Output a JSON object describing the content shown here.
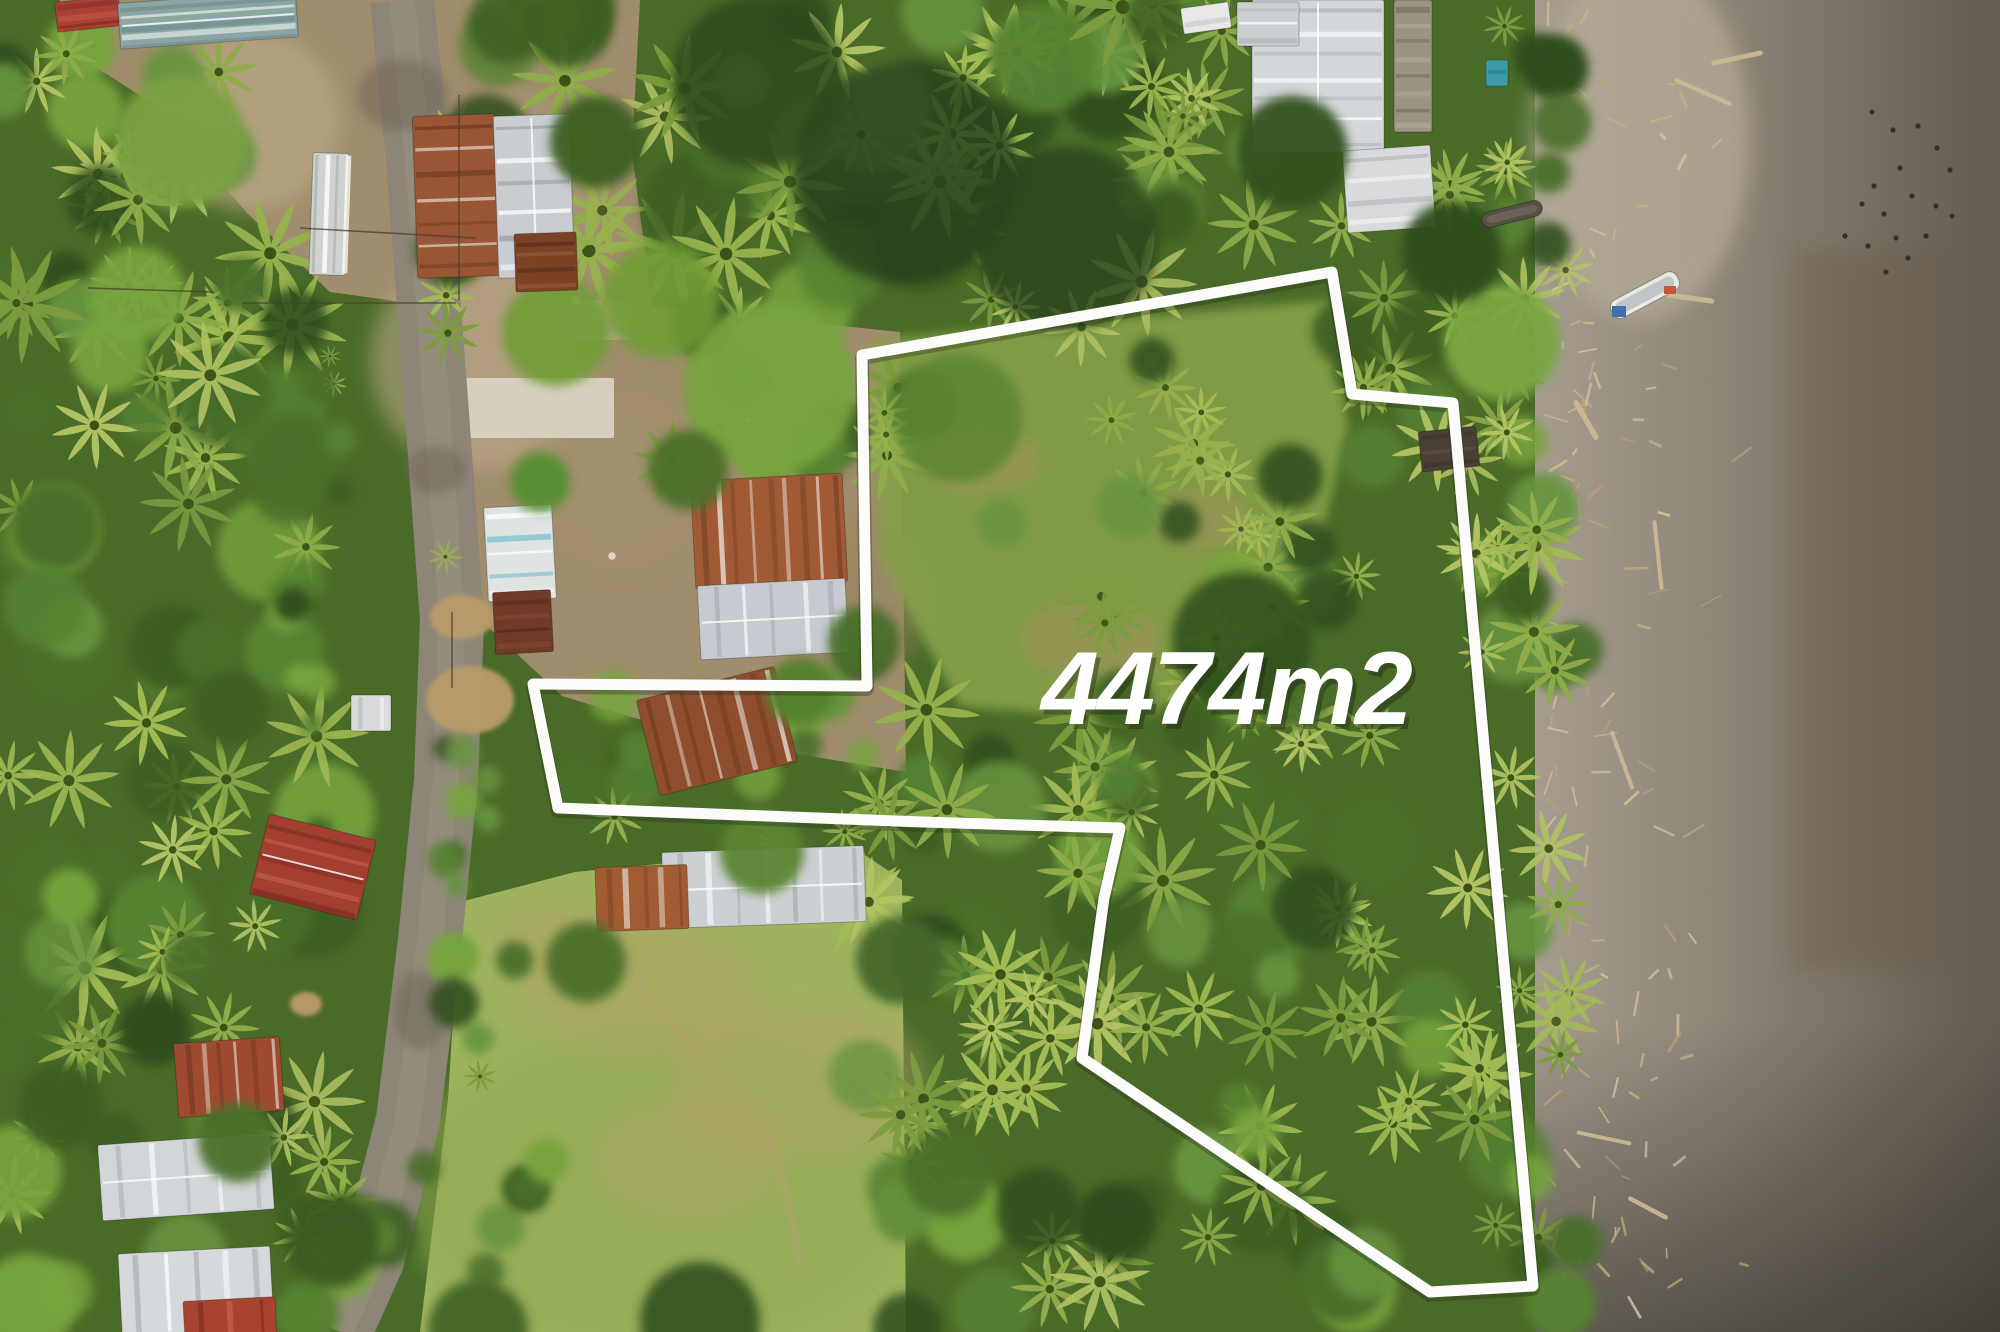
{
  "label": {
    "text": "4474m2",
    "x": 1226,
    "y": 724,
    "color": "#ffffff",
    "shadow": "rgba(25,35,15,0.40)"
  },
  "canvas": {
    "width": 2000,
    "height": 1332
  },
  "palettes": {
    "base": "#4a6b28",
    "canopy": [
      "#2f4d1d",
      "#3c5f24",
      "#49702b",
      "#578231",
      "#679441",
      "#76a43c"
    ],
    "palm": [
      "#8fac4a",
      "#a3bc55",
      "#7d9c3f",
      "#b2c364",
      "#97b14e"
    ],
    "palm_core": "#3c5318"
  },
  "boundary": {
    "stroke": "#ffffff",
    "stroke_width": 11,
    "points": [
      [
        862,
        355
      ],
      [
        1332,
        272
      ],
      [
        1352,
        394
      ],
      [
        1453,
        403
      ],
      [
        1533,
        1286
      ],
      [
        1430,
        1292
      ],
      [
        1082,
        1058
      ],
      [
        1104,
        898
      ],
      [
        1120,
        828
      ],
      [
        923,
        822
      ],
      [
        558,
        808
      ],
      [
        533,
        684
      ],
      [
        867,
        686
      ]
    ]
  },
  "beach": {
    "x": 1535,
    "gradient": [
      "#a59c8e",
      "#8d8578",
      "#746c60",
      "#625c53"
    ],
    "light_blob": [
      1640,
      140,
      110,
      180,
      "#b6ab97"
    ],
    "wet_band": [
      1795,
      250,
      150,
      720,
      "#6a5d4e"
    ],
    "debris": {
      "x0": 1548,
      "x1": 1770,
      "y0": 8,
      "y1": 1326,
      "count": 135,
      "len_min": 7,
      "len_max": 26,
      "colors": [
        "#c9b387",
        "#bba276",
        "#d4c19a"
      ]
    },
    "logs": [
      [
        1703,
        92,
        58,
        24
      ],
      [
        1737,
        58,
        48,
        -12
      ],
      [
        1690,
        298,
        44,
        8
      ],
      [
        1658,
        555,
        66,
        84
      ],
      [
        1622,
        760,
        58,
        70
      ],
      [
        1604,
        1138,
        52,
        12
      ],
      [
        1648,
        1208,
        40,
        28
      ],
      [
        1586,
        420,
        40,
        60
      ]
    ],
    "log_color": "#cdbb92",
    "bird_color": "#2c2a26",
    "birds": [
      [
        1872,
        112
      ],
      [
        1893,
        130
      ],
      [
        1918,
        126
      ],
      [
        1937,
        148
      ],
      [
        1950,
        170
      ],
      [
        1900,
        168
      ],
      [
        1874,
        186
      ],
      [
        1912,
        196
      ],
      [
        1936,
        206
      ],
      [
        1952,
        216
      ],
      [
        1884,
        214
      ],
      [
        1862,
        204
      ],
      [
        1926,
        236
      ],
      [
        1896,
        238
      ],
      [
        1868,
        246
      ],
      [
        1845,
        236
      ],
      [
        1908,
        258
      ],
      [
        1886,
        272
      ]
    ]
  },
  "dirt": {
    "path": "M60,0 H640 L632,152 L652,306 L900,332 L906,772 L702,738 L562,696 L470,610 L450,415 L432,306 L330,292 L248,214 L150,102 L60,44 Z",
    "fill": "#a08d6d",
    "blobs": [
      [
        250,
        120,
        90,
        "#b9a784",
        0.7
      ],
      [
        520,
        180,
        85,
        "#ac9876",
        0.6
      ],
      [
        480,
        360,
        110,
        "#c0ab8c",
        0.55
      ],
      [
        850,
        600,
        80,
        "#96835f",
        0.5
      ],
      [
        620,
        480,
        90,
        "#a5916f",
        0.5
      ]
    ],
    "concrete": [
      462,
      378,
      152,
      60,
      "#d9d2c2"
    ],
    "concrete2": [
      560,
      300,
      70,
      40,
      "#c7bba6"
    ],
    "junk_dots": [
      [
        576,
        300
      ],
      [
        702,
        362
      ],
      [
        832,
        592
      ],
      [
        612,
        556
      ],
      [
        748,
        420
      ]
    ],
    "junk_color": "#e9e3d5"
  },
  "field": {
    "path": "M460,902 L575,872 L720,858 L862,853 L902,880 L906,1332 L420,1332 L448,1100 Z",
    "fill": "#9fb35e",
    "shade": [
      660,
      1190,
      260,
      170,
      "#8fa751"
    ],
    "dry_patches": [
      [
        640,
        990,
        120,
        70
      ],
      [
        800,
        1080,
        130,
        80
      ],
      [
        690,
        1160,
        95,
        60
      ],
      [
        560,
        940,
        70,
        40
      ]
    ],
    "dry_color": "#b4a06a",
    "trail": "M612,955 Q700,1060 762,1120 Q790,1190 800,1270",
    "trail_color": "#b3a071"
  },
  "road": {
    "center": [
      [
        402,
        0
      ],
      [
        418,
        160
      ],
      [
        436,
        400
      ],
      [
        452,
        620
      ],
      [
        446,
        780
      ],
      [
        430,
        940
      ],
      [
        408,
        1120
      ],
      [
        372,
        1260
      ],
      [
        340,
        1332
      ]
    ],
    "width": 64,
    "fill": "#8d8577",
    "hi": "#9c9384",
    "dark_patches": [
      [
        402,
        95,
        46,
        36
      ],
      [
        436,
        470,
        30,
        24
      ],
      [
        420,
        1010,
        26,
        40
      ]
    ],
    "patch_color": "#6e6557",
    "puddles": [
      [
        462,
        617,
        32,
        22
      ],
      [
        470,
        700,
        44,
        34
      ],
      [
        306,
        1004,
        16,
        12
      ]
    ],
    "puddle_color": "#ba9b6a"
  },
  "parcel_grass": {
    "path": "M872,340 L1330,300 L1348,430 L1300,620 L1140,722 L960,706 L880,560 Z",
    "fill": "#86a049",
    "patches": [
      [
        1090,
        640,
        70,
        40
      ],
      [
        980,
        460,
        60,
        35
      ],
      [
        1200,
        520,
        50,
        30
      ]
    ],
    "patch_color": "#a89263"
  },
  "tree_zones": [
    [
      "topleft-trees",
      0,
      40,
      240,
      262,
      18,
      0.4,
      24,
      48
    ],
    [
      "topcenter-forest",
      420,
      0,
      1200,
      335,
      64,
      0.45,
      26,
      56
    ],
    [
      "above-barn",
      650,
      320,
      900,
      478,
      13,
      0.4,
      20,
      40
    ],
    [
      "topright-trees",
      1150,
      0,
      1272,
      235,
      12,
      0.5,
      22,
      44
    ],
    [
      "beachline-top",
      1495,
      0,
      1568,
      430,
      12,
      0.45,
      18,
      36
    ],
    [
      "right-of-parcel-top",
      1330,
      180,
      1530,
      480,
      22,
      0.5,
      20,
      42
    ],
    [
      "left-band-forest",
      0,
      250,
      332,
      1332,
      95,
      0.5,
      22,
      52
    ],
    [
      "notch-bushes",
      556,
      636,
      900,
      844,
      20,
      0.35,
      14,
      34
    ],
    [
      "field-edge",
      420,
      860,
      560,
      1332,
      12,
      0.1,
      12,
      26
    ],
    [
      "roadside-west",
      286,
      318,
      342,
      900,
      14,
      0.1,
      10,
      22
    ],
    [
      "roadside-east",
      440,
      556,
      498,
      905,
      9,
      0.1,
      10,
      20
    ],
    [
      "field-right-forest",
      898,
      828,
      1085,
      1332,
      20,
      0.5,
      22,
      44
    ],
    [
      "parcel-mid-dense",
      1080,
      560,
      1310,
      790,
      18,
      0.5,
      22,
      42
    ],
    [
      "parcel-bottom-forest",
      858,
      700,
      1432,
      1302,
      72,
      0.55,
      22,
      48
    ],
    [
      "parcel-top-sparse",
      880,
      305,
      1320,
      560,
      13,
      0.6,
      18,
      38
    ],
    [
      "parcel-right-band",
      1180,
      380,
      1365,
      700,
      15,
      0.6,
      20,
      40
    ],
    [
      "right-of-parcel-mid",
      1455,
      430,
      1578,
      1332,
      36,
      0.6,
      20,
      44
    ],
    [
      "bottom-left-extra",
      300,
      1200,
      430,
      1332,
      8,
      0.3,
      18,
      36
    ]
  ],
  "accent_canopies": [
    [
      770,
      388,
      86,
      "#76a43c",
      0.95
    ],
    [
      662,
      300,
      58,
      "#6f9c35",
      0.9
    ],
    [
      180,
      142,
      66,
      "#79a143",
      0.95
    ],
    [
      905,
      172,
      112,
      "#26401a",
      0.8
    ],
    [
      1066,
      238,
      92,
      "#2b451c",
      0.8
    ],
    [
      758,
      82,
      86,
      "#2e4a1e",
      0.85
    ],
    [
      556,
      332,
      54,
      "#6f9c35",
      0.9
    ],
    [
      1242,
      642,
      70,
      "#33511f",
      0.9
    ],
    [
      1502,
      342,
      58,
      "#7aa742",
      0.95
    ],
    [
      958,
      418,
      64,
      "#5a8533",
      0.85
    ]
  ],
  "buildings": [
    [
      "roof-topleft-red",
      88,
      14,
      64,
      30,
      -6,
      "#a84034",
      3,
      "h",
      "#c05a48",
      "#7e2c22",
      false
    ],
    [
      "roof-topleft-teal",
      208,
      20,
      178,
      46,
      -4,
      "#8aa5a3",
      5,
      "h",
      "#ffffff",
      "#6d8a8a",
      true
    ],
    [
      "shed-roadside-white",
      329,
      214,
      36,
      122,
      2,
      "#cfd2cf",
      4,
      "v",
      "#ffffff",
      "#aab0ae",
      false
    ],
    [
      "house-top-rust",
      456,
      196,
      82,
      162,
      -2,
      "#9a5634",
      7,
      "h",
      "#ddd8cc",
      "#6e3b22",
      false
    ],
    [
      "house-top-silver",
      534,
      196,
      76,
      162,
      -2,
      "#c9ccd1",
      6,
      "h",
      "#ffffff",
      "#9aa0a6",
      true
    ],
    [
      "shed-rust-dark",
      546,
      262,
      62,
      58,
      -2,
      "#7c4226",
      4,
      "h",
      "#9a5a36",
      "#5e2f1a",
      false
    ],
    [
      "house-teal-white",
      520,
      553,
      68,
      94,
      -3,
      "#dfe3e2",
      5,
      "h",
      "#5fb7c4",
      "#ffffff",
      false
    ],
    [
      "roof-brown-dark",
      523,
      622,
      58,
      62,
      -3,
      "#6f3a28",
      4,
      "h",
      "#8a4a32",
      "#54291c",
      false
    ],
    [
      "barn-rust",
      769,
      531,
      152,
      108,
      -3,
      "#a05a36",
      9,
      "v",
      "#e8e4da",
      "#7c4426",
      false
    ],
    [
      "barn-silver",
      773,
      619,
      148,
      74,
      -3,
      "#c7cad0",
      5,
      "v",
      "#ffffff",
      "#a8adb4",
      true
    ],
    [
      "house-notch-rust",
      717,
      731,
      142,
      98,
      -14,
      "#8e4e2e",
      8,
      "v",
      "#e3ded2",
      "#6e3a20",
      false
    ],
    [
      "house-bottom-silver",
      764,
      887,
      202,
      76,
      -2,
      "#ccd0d4",
      7,
      "v",
      "#ffffff",
      "#a9aeb5",
      true
    ],
    [
      "house-bottom-rust",
      642,
      898,
      92,
      64,
      -2,
      "#a25c33",
      5,
      "v",
      "#d8cfc0",
      "#7c4426",
      false
    ],
    [
      "house-bl-red",
      229,
      1077,
      106,
      74,
      -4,
      "#9e4a30",
      6,
      "v",
      "#d8cabb",
      "#763722",
      false
    ],
    [
      "house-bl-white",
      186,
      1177,
      172,
      76,
      -4,
      "#d3d6d9",
      5,
      "v",
      "#ffffff",
      "#adb2b6",
      true
    ],
    [
      "house-bl2-white",
      196,
      1291,
      152,
      82,
      -3,
      "#d6d9db",
      5,
      "v",
      "#ffffff",
      "#afb4b8",
      false
    ],
    [
      "house-bl2-red",
      230,
      1320,
      92,
      42,
      -3,
      "#a8432f",
      3,
      "v",
      "#c9604a",
      "#7e2c20",
      false
    ],
    [
      "house-red-midleft",
      313,
      867,
      110,
      82,
      14,
      "#a33f2f",
      5,
      "h",
      "#c86a50",
      "#7e2e20",
      true
    ],
    [
      "shack-white-road",
      371,
      713,
      40,
      36,
      0,
      "#d9dbd8",
      2,
      "v",
      "#ffffff",
      "#b8bcb9",
      false
    ],
    [
      "bldg-tr-main",
      1318,
      76,
      132,
      152,
      0,
      "#d4d7da",
      7,
      "h",
      "#ffffff",
      "#b0b5ba",
      true
    ],
    [
      "bldg-tr-wing",
      1268,
      24,
      62,
      44,
      0,
      "#cdd0d3",
      3,
      "h",
      "#ffffff",
      "#b0b5ba",
      false
    ],
    [
      "bldg-tr-lower",
      1389,
      189,
      88,
      82,
      -4,
      "#d8dadc",
      4,
      "h",
      "#ffffff",
      "#b4b8bc",
      false
    ],
    [
      "palapa-thatch",
      1413,
      66,
      38,
      132,
      0,
      "#9b9484",
      8,
      "h",
      "#b5ad9c",
      "#7a7263",
      false
    ],
    [
      "truck-white",
      1206,
      18,
      48,
      26,
      -8,
      "#e8e8e6",
      1,
      "h",
      "#ffffff",
      "#c9c9c5",
      false
    ],
    [
      "tarp-teal",
      1497,
      73,
      22,
      26,
      0,
      "#3e9aa8",
      1,
      "h",
      "#5fb7c4",
      "#2e7c88",
      false
    ],
    [
      "hut-dark-right",
      1449,
      449,
      58,
      40,
      -6,
      "#4a4036",
      3,
      "h",
      "#5c5144",
      "#3a322a",
      false
    ]
  ],
  "overhangs": [
    [
      688,
      470,
      40,
      "#4c712c"
    ],
    [
      800,
      692,
      34,
      "#55802f"
    ],
    [
      596,
      142,
      46,
      "#3c5f24"
    ],
    [
      864,
      642,
      36,
      "#49702b"
    ],
    [
      540,
      482,
      30,
      "#579033"
    ],
    [
      762,
      852,
      42,
      "#5a8533"
    ],
    [
      238,
      1142,
      40,
      "#4c712c"
    ],
    [
      332,
      1242,
      46,
      "#3b5c24"
    ],
    [
      1292,
      152,
      56,
      "#33511f"
    ],
    [
      1452,
      252,
      50,
      "#2f4d1d"
    ],
    [
      700,
      1322,
      60,
      "#375722"
    ],
    [
      478,
      1330,
      50,
      "#426526"
    ],
    [
      586,
      962,
      40,
      "#4c712c"
    ],
    [
      900,
      960,
      44,
      "#44672a"
    ]
  ],
  "boats": [
    [
      "boat-white",
      1645,
      295,
      74,
      20,
      -28,
      "#e9e9e4",
      "#b8bec2"
    ],
    [
      "boat-dark",
      1512,
      214,
      62,
      16,
      -14,
      "#555045",
      "#6d675a"
    ]
  ],
  "boat_items": [
    [
      1612,
      306,
      14,
      11,
      "#3e6fae"
    ],
    [
      1664,
      286,
      12,
      8,
      "#c4563c"
    ]
  ],
  "fences": {
    "color": "#4e3f2d",
    "lines": [
      [
        459,
        95,
        459,
        300
      ],
      [
        242,
        303,
        456,
        303
      ],
      [
        300,
        228,
        476,
        238
      ],
      [
        452,
        612,
        452,
        688
      ],
      [
        88,
        288,
        212,
        292
      ]
    ]
  }
}
